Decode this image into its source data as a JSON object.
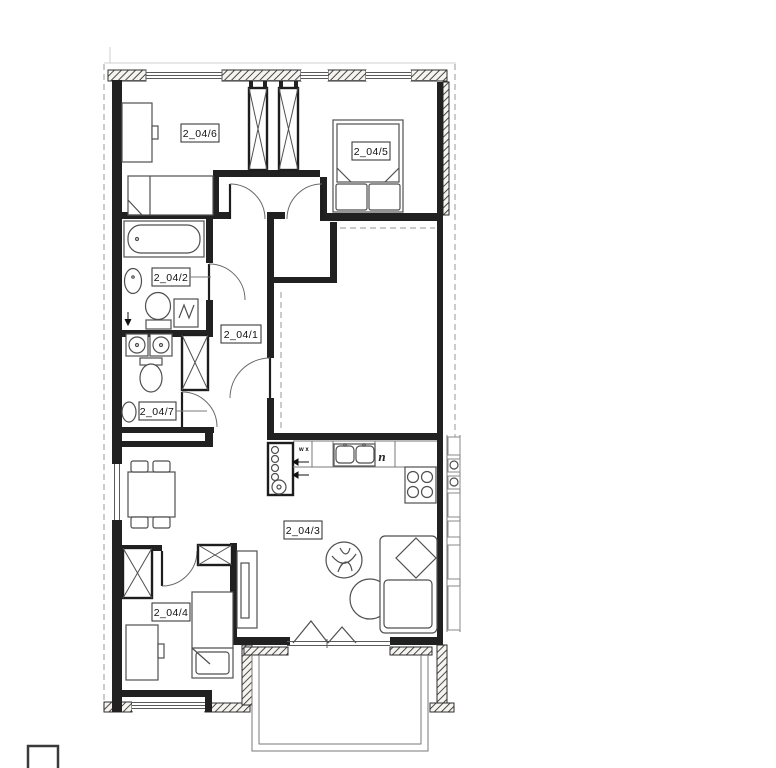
{
  "plan": {
    "title": "apartment-floor-plan",
    "rooms": [
      {
        "key": "bedroom-top-left",
        "label": "2_04/6"
      },
      {
        "key": "bedroom-top-right",
        "label": "2_04/5"
      },
      {
        "key": "bathroom",
        "label": "2_04/2"
      },
      {
        "key": "hallway",
        "label": "2_04/1"
      },
      {
        "key": "wc",
        "label": "2_04/7"
      },
      {
        "key": "living-kitchen",
        "label": "2_04/3"
      },
      {
        "key": "bedroom-bottom",
        "label": "2_04/4"
      }
    ],
    "marks": {
      "kitchen_vent": "w x",
      "kitchen_niche": "n"
    }
  },
  "colors": {
    "wall": "#212121",
    "furniture_stroke": "#4f4f4f",
    "hatch_stroke": "#2e2e2e",
    "dashed_line": "#ababab",
    "paper": "#ffffff"
  }
}
